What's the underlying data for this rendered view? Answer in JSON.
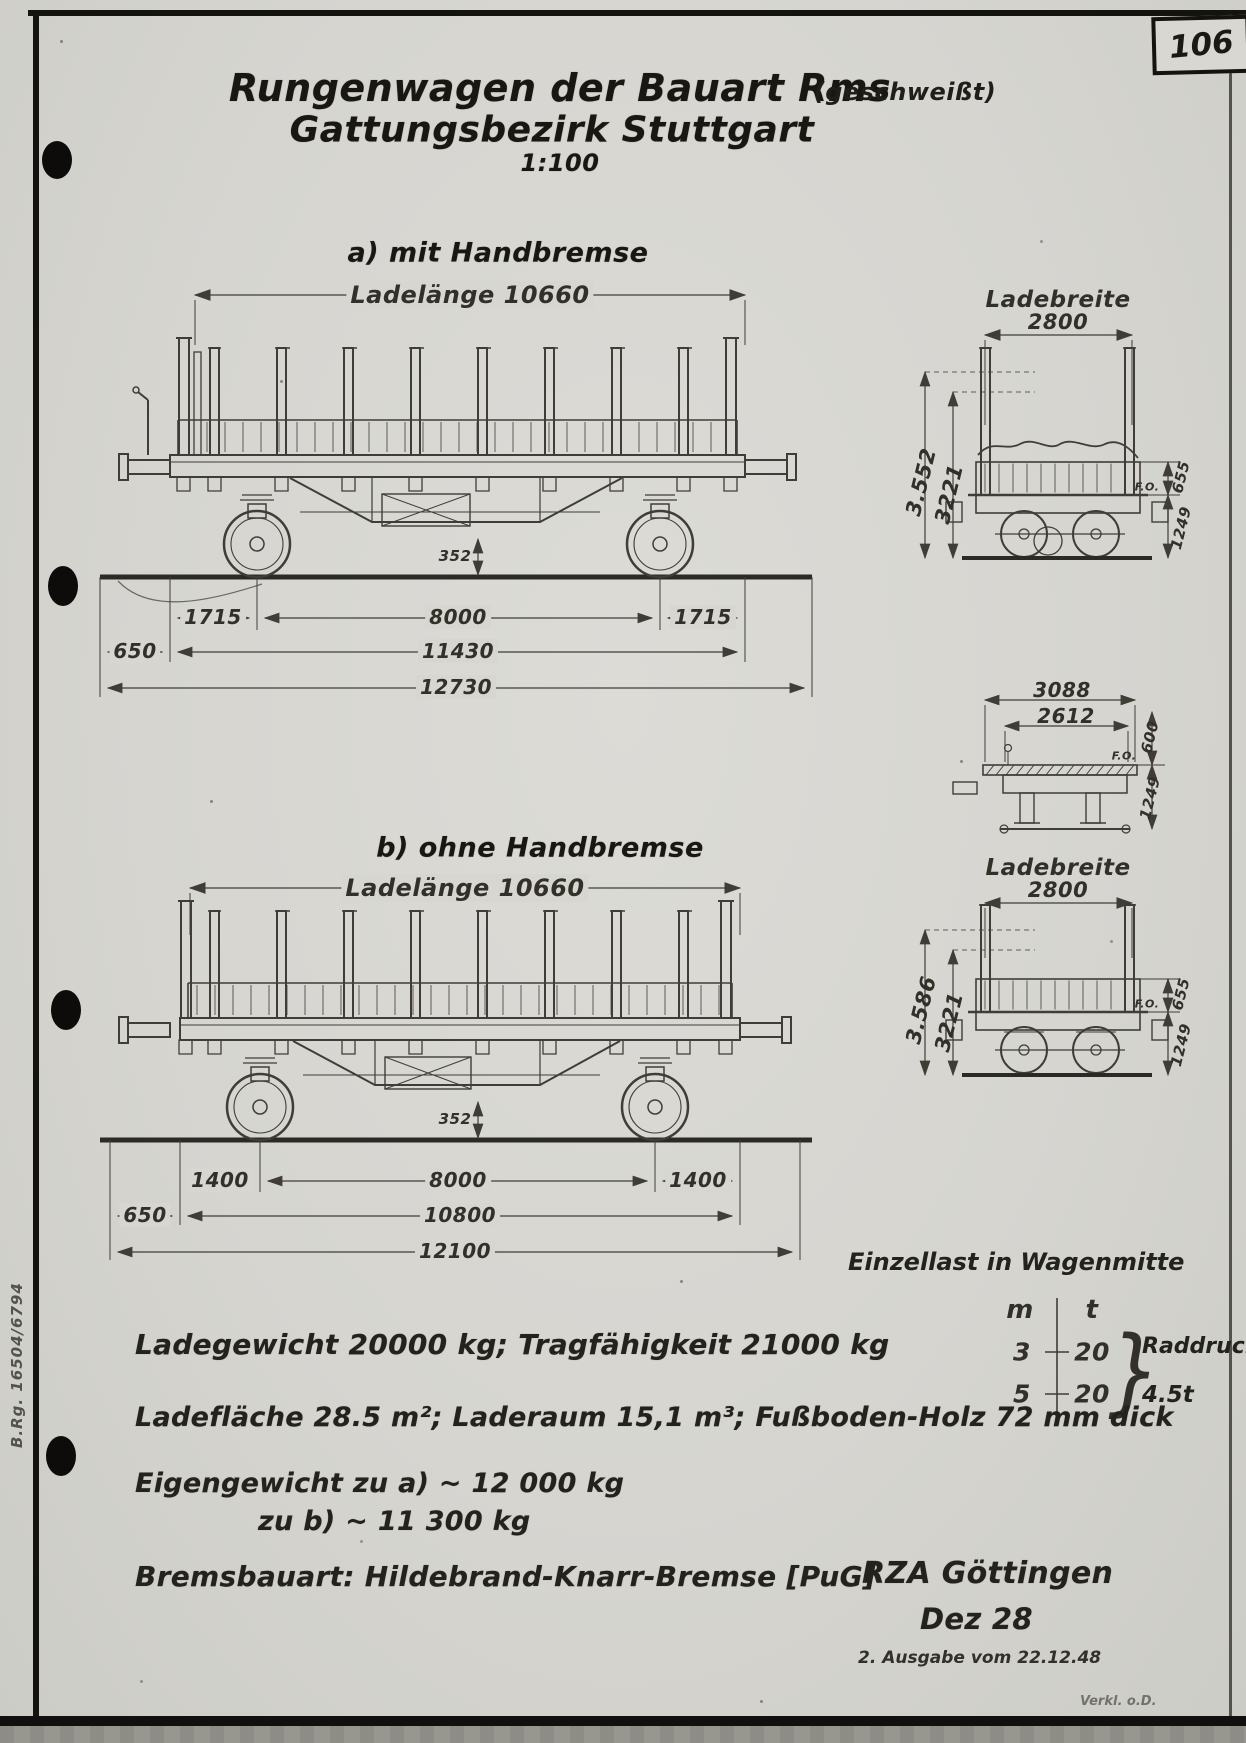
{
  "page": {
    "number": "106",
    "margin_note": "B.Rg. 16504/6794",
    "footer_note": "Verkl. o.D."
  },
  "title": {
    "main": "Rungenwagen der Bauart Rms",
    "suffix": "(geschweißt)",
    "subtitle": "Gattungsbezirk Stuttgart",
    "scale": "1:100"
  },
  "view_a": {
    "heading": "a) mit Handbremse",
    "ladelaenge": "Ladelänge 10660",
    "dim_352": "352",
    "row1": [
      "1715",
      "8000",
      "1715"
    ],
    "row2": [
      "650",
      "11430"
    ],
    "row3": "12730"
  },
  "end_a": {
    "ladebreite_label": "Ladebreite",
    "ladebreite": "2800",
    "height_total": "3.552",
    "height_frame": "3221",
    "fo": "F.O.",
    "board_height": "655",
    "floor_height": "1249"
  },
  "mid_section": {
    "width_top": "3088",
    "width_inner": "2612",
    "fo": "F.O.",
    "edge_height": "600",
    "floor_height": "1249"
  },
  "view_b": {
    "heading": "b) ohne Handbremse",
    "ladelaenge": "Ladelänge 10660",
    "dim_352": "352",
    "row1": [
      "1400",
      "8000",
      "1400"
    ],
    "row2": [
      "650",
      "10800"
    ],
    "row3": "12100"
  },
  "end_b": {
    "ladebreite_label": "Ladebreite",
    "ladebreite": "2800",
    "height_total": "3.586",
    "height_frame": "3221",
    "fo": "F.O.",
    "board_height": "655",
    "floor_height": "1249"
  },
  "load_table": {
    "title": "Einzellast in Wagenmitte",
    "col_m": "m",
    "col_t": "t",
    "rows": [
      {
        "m": "3",
        "t": "20"
      },
      {
        "m": "5",
        "t": "20"
      }
    ],
    "brace": "}",
    "note_line1": "Raddruck",
    "note_line2": "4.5t"
  },
  "specs": {
    "line1": "Ladegewicht 20000 kg; Tragfähigkeit 21000 kg",
    "line2": "Ladefläche 28.5 m²; Laderaum 15,1 m³; Fußboden-Holz 72 mm dick",
    "line3a": "Eigengewicht zu a) ~ 12 000 kg",
    "line3b": "zu b) ~ 11 300 kg",
    "line4": "Bremsbauart: Hildebrand-Knarr-Bremse [PuG]"
  },
  "imprint": {
    "office": "RZA Göttingen",
    "date": "Dez 28",
    "edition": "2. Ausgabe vom 22.12.48"
  }
}
